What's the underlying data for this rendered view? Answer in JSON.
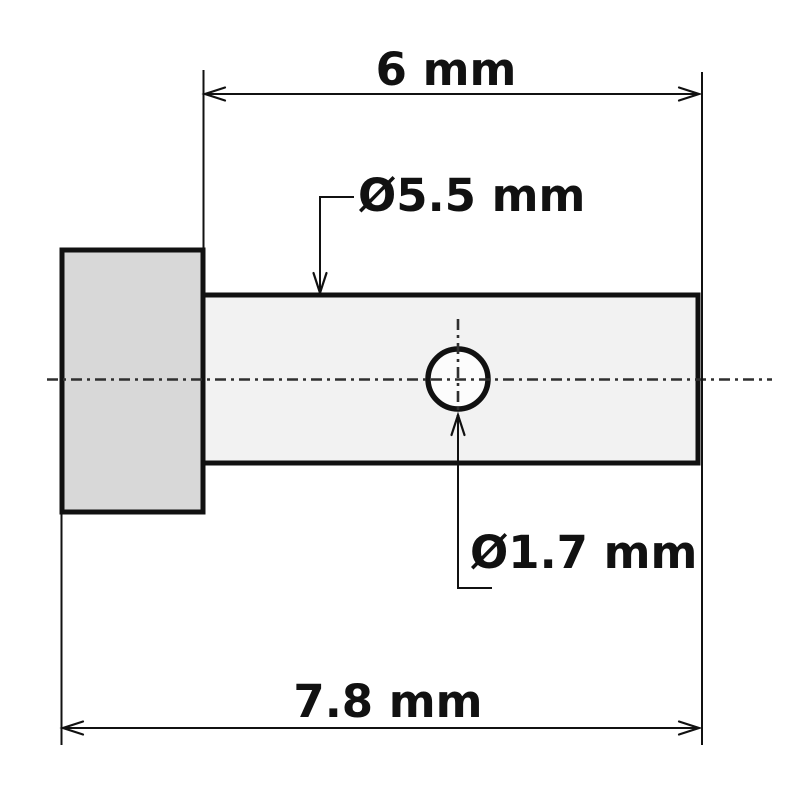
{
  "drawing": {
    "dimensions": {
      "shaft_length": "6 mm",
      "shaft_diameter": "Ø5.5 mm",
      "hole_diameter": "Ø1.7 mm",
      "overall_length": "7.8 mm"
    },
    "colors": {
      "head_fill": "#d8d8d8",
      "shaft_fill": "#f2f2f2",
      "hole_fill": "#fcfcfc",
      "line": "#111111",
      "centerline": "#2f2f2f",
      "background": "#ffffff"
    }
  }
}
